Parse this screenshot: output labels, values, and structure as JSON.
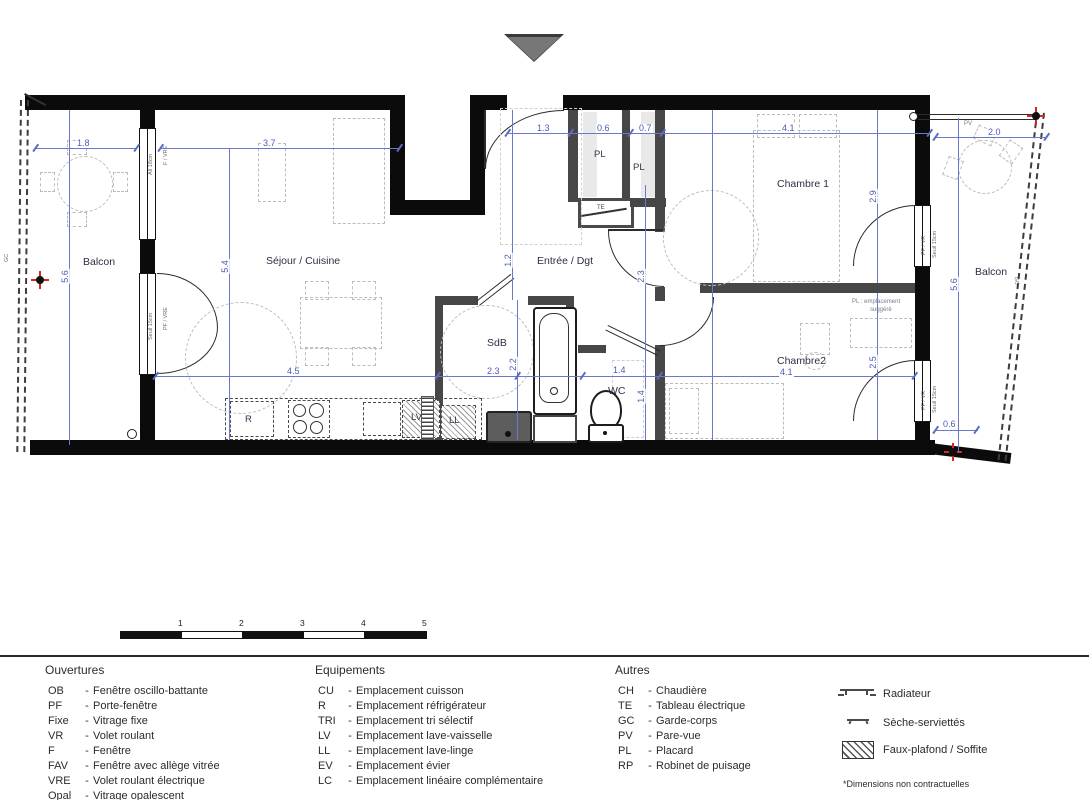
{
  "plan": {
    "rooms": [
      {
        "label": "Balcon"
      },
      {
        "label": "Séjour / Cuisine"
      },
      {
        "label": "Entrée / Dgt"
      },
      {
        "label": "Chambre 1"
      },
      {
        "label": "Chambre2"
      },
      {
        "label": "SdB"
      },
      {
        "label": "WC"
      },
      {
        "label": "Balcon"
      }
    ],
    "tags": {
      "pl": "PL",
      "te": "TE",
      "r": "R",
      "lv": "LV",
      "ll": "LL",
      "gc": "GC",
      "pv": "PV",
      "pl_sugg_line1": "PL : emplacement",
      "pl_sugg_line2": "suggéré"
    },
    "window_labels": {
      "f_vre": "F / VRE",
      "all_18": "All 18cm",
      "pf_vre": "PF / VRE",
      "seuil_15": "Seuil 15cm",
      "pf_vr": "PF / VR"
    },
    "dims": [
      "1.8",
      "3.7",
      "1.3",
      "0.6",
      "0.7",
      "4.1",
      "2.0",
      "5.6",
      "5.4",
      "1.2",
      "2.3",
      "2.9",
      "2.5",
      "5.6",
      "4.5",
      "2.3",
      "2.2",
      "1.4",
      "1.4",
      "4.1",
      "0.6"
    ]
  },
  "scale_bar": {
    "ticks": [
      "1",
      "2",
      "3",
      "4",
      "5"
    ]
  },
  "legend": {
    "sep": "-",
    "columns": [
      {
        "title": "Ouvertures",
        "items": [
          {
            "code": "OB",
            "label": "Fenêtre oscillo-battante"
          },
          {
            "code": "PF",
            "label": "Porte-fenêtre"
          },
          {
            "code": "Fixe",
            "label": "Vitrage fixe"
          },
          {
            "code": "VR",
            "label": "Volet roulant"
          },
          {
            "code": "F",
            "label": "Fenêtre"
          },
          {
            "code": "FAV",
            "label": "Fenêtre avec allège vitrée"
          },
          {
            "code": "VRE",
            "label": "Volet roulant électrique"
          },
          {
            "code": "Opal",
            "label": "Vitrage opalescent"
          }
        ]
      },
      {
        "title": "Equipements",
        "items": [
          {
            "code": "CU",
            "label": "Emplacement cuisson"
          },
          {
            "code": "R",
            "label": "Emplacement réfrigérateur"
          },
          {
            "code": "TRI",
            "label": "Emplacement tri sélectif"
          },
          {
            "code": "LV",
            "label": "Emplacement lave-vaisselle"
          },
          {
            "code": "LL",
            "label": "Emplacement lave-linge"
          },
          {
            "code": "EV",
            "label": "Emplacement évier"
          },
          {
            "code": "LC",
            "label": "Emplacement linéaire complémentaire"
          }
        ]
      },
      {
        "title": "Autres",
        "items": [
          {
            "code": "CH",
            "label": "Chaudière"
          },
          {
            "code": "TE",
            "label": "Tableau électrique"
          },
          {
            "code": "GC",
            "label": "Garde-corps"
          },
          {
            "code": "PV",
            "label": "Pare-vue"
          },
          {
            "code": "PL",
            "label": "Placard"
          },
          {
            "code": "RP",
            "label": "Robinet de puisage"
          }
        ]
      }
    ],
    "symbols": [
      {
        "label": "Radiateur"
      },
      {
        "label": "Sèche-serviettés"
      },
      {
        "label": "Faux-plafond / Soffite"
      }
    ],
    "note": "*Dimensions non contractuelles"
  }
}
